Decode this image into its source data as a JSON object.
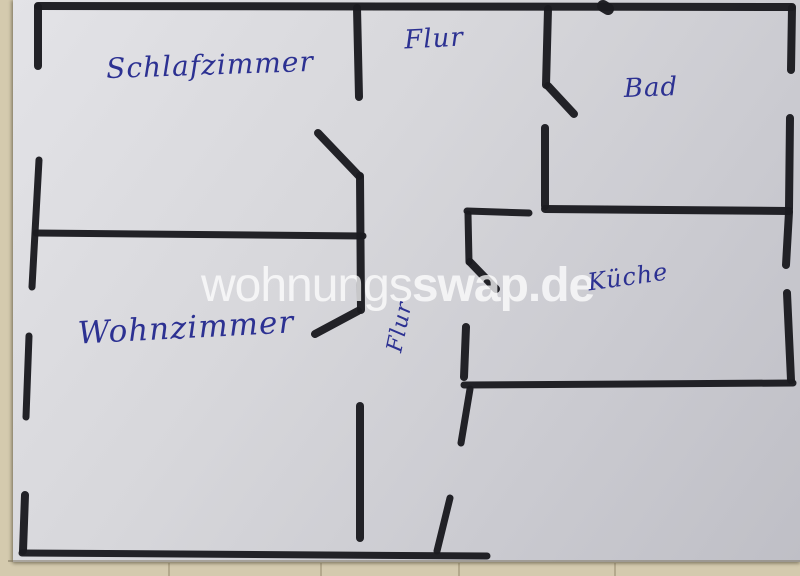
{
  "meta": {
    "description": "Hand-drawn apartment floor plan sketch on paper, photographed",
    "site_watermark": "wohnungsswap.de"
  },
  "colors": {
    "table": "#d4caae",
    "paper_light": "#e3e3e7",
    "paper_dark": "#bfbfc6",
    "wall_ink": "#1b1b20",
    "label_ink": "#2c3192",
    "watermark": "#ffffff"
  },
  "watermark": {
    "light": "wohnungs",
    "bold": "swap.de"
  },
  "labels": [
    {
      "id": "schlafzimmer",
      "text": "Schlafzimmer",
      "x": 210,
      "y": 65,
      "size": 28,
      "rot": -2
    },
    {
      "id": "flur-top",
      "text": "Flur",
      "x": 434,
      "y": 39,
      "size": 26,
      "rot": -3
    },
    {
      "id": "bad",
      "text": "Bad",
      "x": 651,
      "y": 88,
      "size": 26,
      "rot": -2
    },
    {
      "id": "kueche",
      "text": "Küche",
      "x": 628,
      "y": 277,
      "size": 24,
      "rot": -8
    },
    {
      "id": "wohnzimmer",
      "text": "Wohnzimmer",
      "x": 186,
      "y": 328,
      "size": 31,
      "rot": -3
    },
    {
      "id": "flur-vertical",
      "text": "Flur",
      "x": 400,
      "y": 327,
      "size": 22,
      "rot": -78
    }
  ],
  "walls": [
    [
      38,
      6,
      792,
      7,
      8
    ],
    [
      603,
      6,
      608,
      9,
      12
    ],
    [
      38,
      7,
      38,
      66,
      8
    ],
    [
      39,
      160,
      32,
      287,
      7
    ],
    [
      29,
      336,
      26,
      417,
      7
    ],
    [
      25,
      495,
      23,
      551,
      8
    ],
    [
      22,
      553,
      487,
      556,
      7
    ],
    [
      36,
      233,
      363,
      236,
      7
    ],
    [
      357,
      8,
      359,
      97,
      8
    ],
    [
      318,
      133,
      359,
      176,
      8
    ],
    [
      360,
      176,
      361,
      310,
      8
    ],
    [
      358,
      311,
      315,
      334,
      8
    ],
    [
      360,
      406,
      360,
      538,
      8
    ],
    [
      548,
      9,
      546,
      85,
      8
    ],
    [
      548,
      86,
      574,
      114,
      8
    ],
    [
      545,
      128,
      545,
      206,
      8
    ],
    [
      545,
      209,
      789,
      211,
      8
    ],
    [
      467,
      211,
      529,
      213,
      7
    ],
    [
      468,
      214,
      469,
      262,
      7
    ],
    [
      470,
      262,
      496,
      289,
      8
    ],
    [
      466,
      327,
      464,
      377,
      8
    ],
    [
      464,
      385,
      793,
      383,
      7
    ],
    [
      470,
      389,
      461,
      443,
      7
    ],
    [
      450,
      498,
      437,
      551,
      7
    ],
    [
      792,
      8,
      791,
      70,
      8
    ],
    [
      790,
      118,
      789,
      209,
      8
    ],
    [
      789,
      212,
      786,
      265,
      8
    ],
    [
      787,
      293,
      791,
      380,
      8
    ]
  ]
}
